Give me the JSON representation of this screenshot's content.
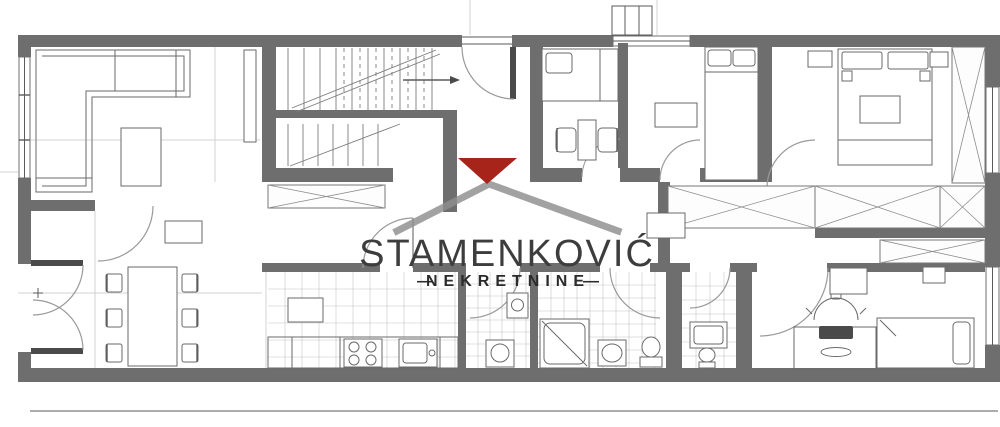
{
  "watermark": {
    "brand": "STAMENKOVIĆ",
    "tagline": "NEKRETNINE",
    "dash": "—"
  },
  "icons": [
    "house-roof-icon",
    "red-gable-triangle-icon",
    "staircase-icon",
    "stair-direction-arrow-icon",
    "sofa-icon",
    "coffee-table-icon",
    "dining-table-icon",
    "chair-icon",
    "double-bed-icon",
    "single-bed-icon",
    "wardrobe-x-icon",
    "stove-burners-icon",
    "kitchen-sink-icon",
    "shower-icon",
    "toilet-icon",
    "washbasin-icon",
    "washing-machine-icon",
    "office-chair-icon",
    "desk-icon",
    "door-swing-arc-icon",
    "window-icon"
  ],
  "colors": {
    "wall": "#6e6e6e",
    "line": "#5a5a5a",
    "faint": "#c9c9c9",
    "tile": "#9a9a9a",
    "logo_gray": "#8e8e8e",
    "logo_red": "#a6241a",
    "text_dark": "#3d3d3d",
    "background": "#ffffff"
  }
}
